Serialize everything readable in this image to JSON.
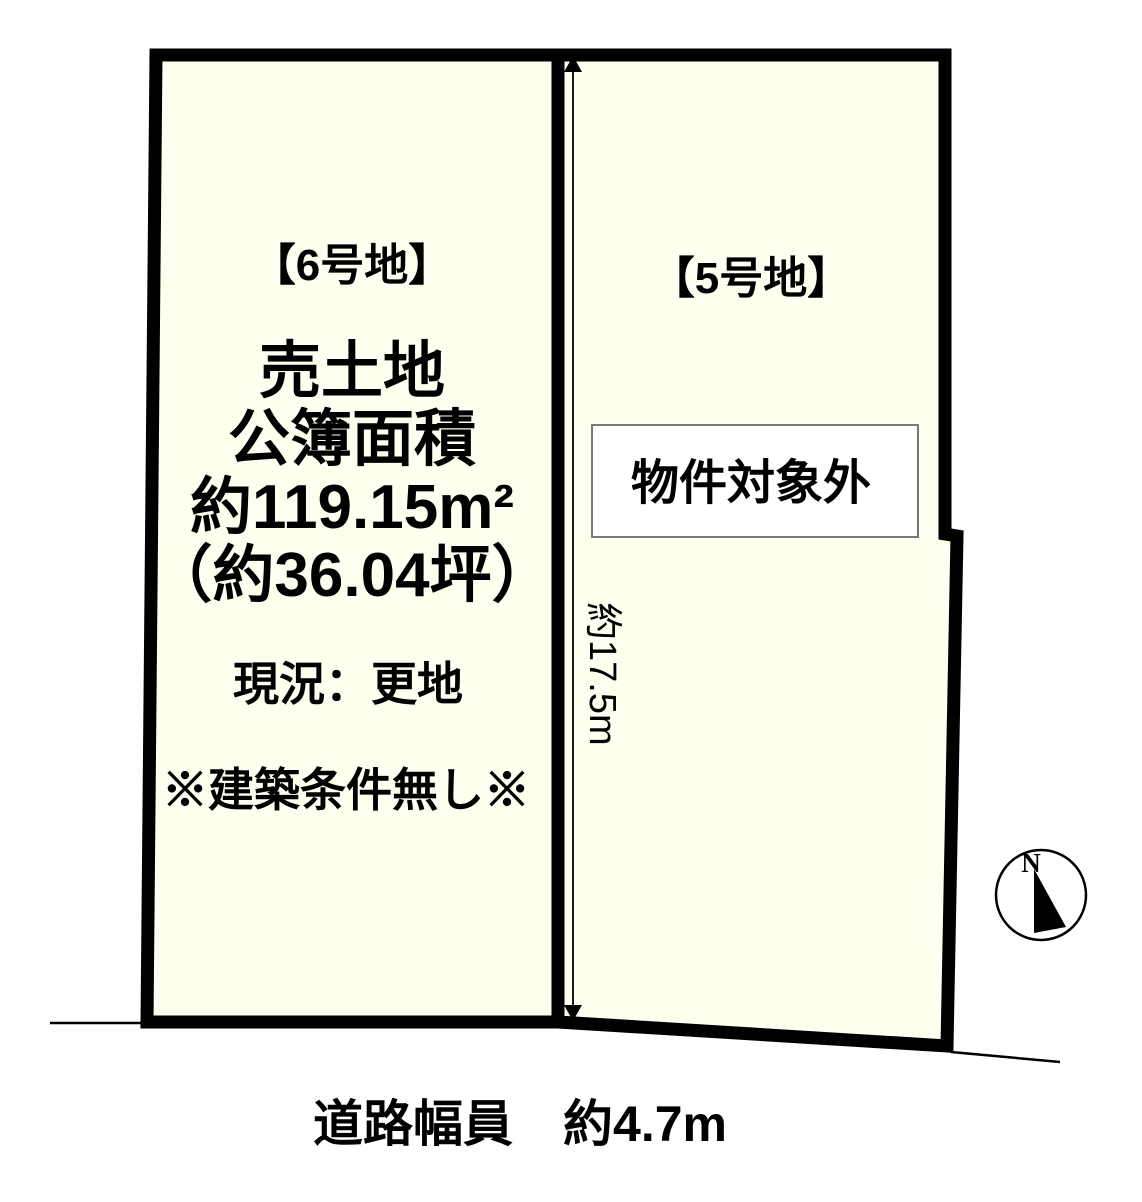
{
  "colors": {
    "parcel_fill": "#FFFFF0",
    "border": "#000000",
    "box_fill": "#FFFFFF",
    "box_border": "#7A7A7A",
    "dimension_line": "#1A1A1A"
  },
  "parcel6": {
    "label": "【6号地】",
    "lines": [
      "売土地",
      "公簿面積",
      "約119.15m²",
      "（約36.04坪）"
    ],
    "status": "現況：更地",
    "note": "※建築条件無し※"
  },
  "parcel5": {
    "label": "【5号地】",
    "box_label": "物件対象外"
  },
  "dimension": {
    "depth_label": "約17.5m"
  },
  "road": {
    "label": "道路幅員　約4.7m"
  },
  "compass": {
    "north_label": "N"
  }
}
